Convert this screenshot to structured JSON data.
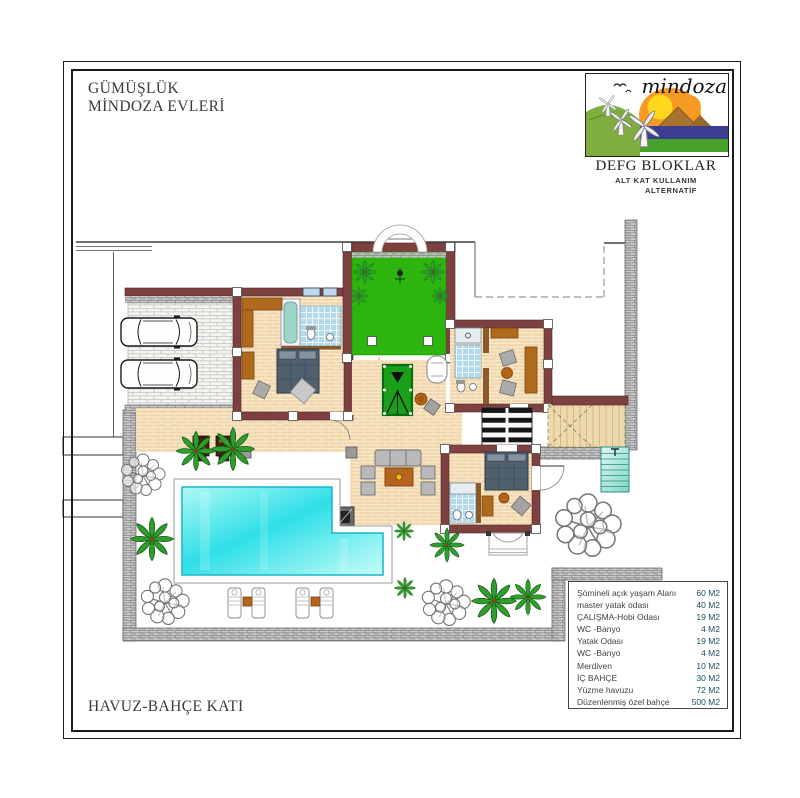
{
  "title_block": {
    "line1": "GÜMÜŞLÜK",
    "line2": "MİNDOZA EVLERİ"
  },
  "logo": {
    "brand": "mindoza",
    "block_title": "DEFG BLOKLAR",
    "subtitle1": "ALT KAT KULLANIM",
    "subtitle2": "ALTERNATİF"
  },
  "floor_label": "HAVUZ-BAHÇE KATI",
  "legend": {
    "rows": [
      {
        "label": "Şömineli açık yaşam Alanı",
        "value": "60 M2"
      },
      {
        "label": "master yatak odası",
        "value": "40 M2"
      },
      {
        "label": "ÇALIŞMA-Hobi Odası",
        "value": "19 M2"
      },
      {
        "label": "WC -Banyo",
        "value": "4 M2"
      },
      {
        "label": "Yatak Odası",
        "value": "19 M2"
      },
      {
        "label": "WC -Banyo",
        "value": "4 M2"
      },
      {
        "label": "Merdiven",
        "value": "10 M2"
      },
      {
        "label": "İÇ BAHÇE",
        "value": "30 M2"
      },
      {
        "label": "Yüzme havuzu",
        "value": "72 M2"
      },
      {
        "label": "Düzenlenmiş özel bahçe",
        "value": "500 M2"
      }
    ]
  },
  "colors": {
    "wall_maroon": "#7d4141",
    "garden_green": "#2cb60d",
    "pool_cyan": "#35dfe8",
    "terrace_tan": "#f1d7ae",
    "boundary_gray": "#c9c9c9",
    "tile_blue": "#b4d9e9"
  }
}
